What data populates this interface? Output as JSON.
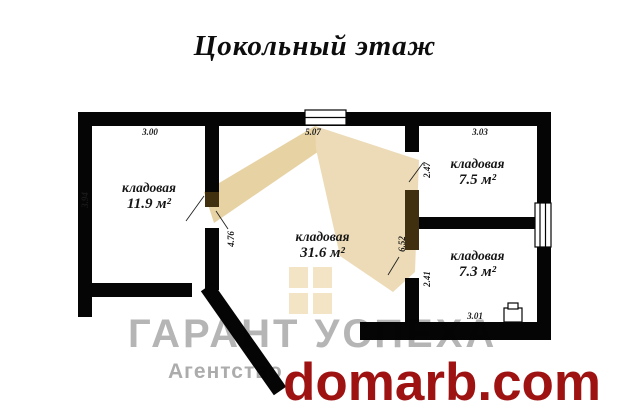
{
  "title": "Цокольный этаж",
  "rooms": [
    {
      "name": "кладовая",
      "area": "11.9 м²"
    },
    {
      "name": "кладовая",
      "area": "31.6 м²"
    },
    {
      "name": "кладовая",
      "area": "7.5 м²"
    },
    {
      "name": "кладовая",
      "area": "7.3 м²"
    }
  ],
  "dimensions": {
    "left_room_width": "3.00",
    "middle_room_width": "5.07",
    "right_room_width": "3.03",
    "left_room_height": "3.94",
    "middle_room_height": "4.76",
    "right_top_room_height": "2.47",
    "middle_right_wall": "6.52",
    "right_bottom_room_height": "2.41",
    "right_bottom_room_width": "3.01"
  },
  "watermark": {
    "brand": "ГАРАНТ УСПЕХА",
    "agency": "Агентство",
    "site": "domarb.com"
  },
  "colors": {
    "wall": "#050505",
    "watermark_beige": "#ecdbb6",
    "watermark_beige_dark": "#e7d2a4",
    "logo_square_beige": "#f2e4c4",
    "overlap_brown": "#41300f",
    "watermark_gray": "#b5b5b5",
    "brand_red": "#9e1212"
  }
}
